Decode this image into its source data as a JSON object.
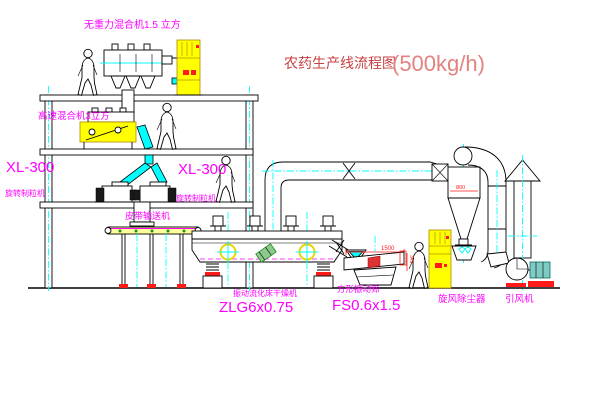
{
  "title": {
    "name": "农药生产线流程图",
    "capacity": "(500kg/h)"
  },
  "labels": {
    "top_mixer": "无重力混合机1.5 立方",
    "mid_mixer": "高速混合机3立方",
    "granulator_left_model": "XL-300",
    "granulator_left_name": "旋转制粒机",
    "granulator_right_model": "XL-300",
    "granulator_right_name": "旋转制粒机",
    "belt_conveyor": "皮带输送机",
    "dryer_name": "振动流化床干燥机",
    "dryer_model": "ZLG6x0.75",
    "screen_name": "方形振动筛",
    "screen_model": "FS0.6x1.5",
    "cyclone_name": "旋风除尘器",
    "fan_name": "引风机"
  },
  "dimensions": {
    "screen_length": "1500",
    "screen_height": "341",
    "cyclone_width": "800"
  },
  "colors": {
    "background": "#FFFFFF",
    "magenta": "#FF00FF",
    "titleRed": "#C94040",
    "titleLight": "#E2837F",
    "yellow": "#FFFF00",
    "cyan": "#00FFFF",
    "red": "#FF1A1A",
    "green": "#1F8F1F"
  }
}
